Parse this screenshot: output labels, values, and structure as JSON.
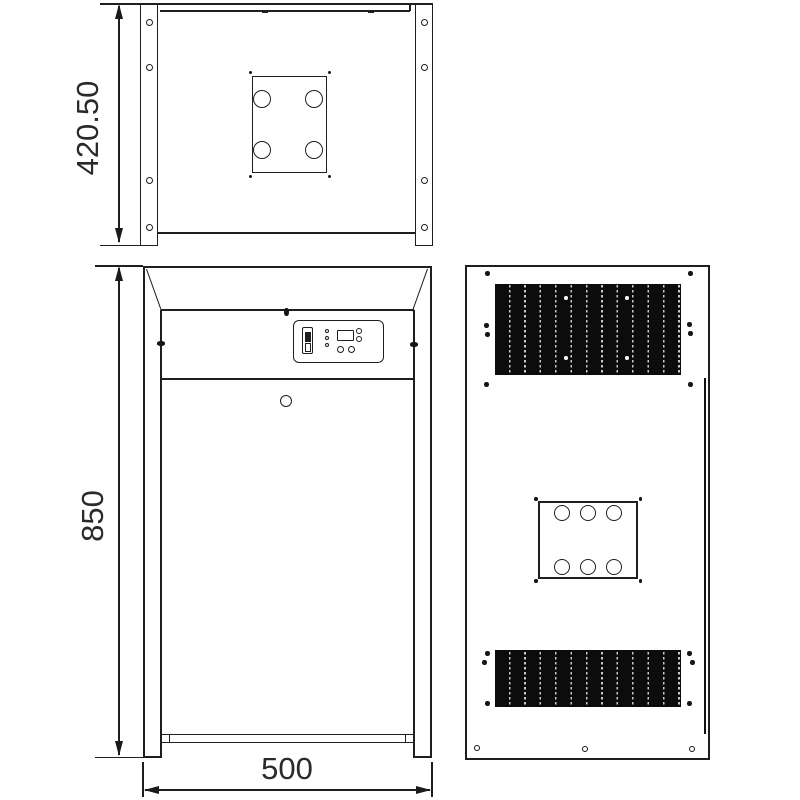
{
  "drawing": {
    "labels": {
      "depth": "420.50",
      "height": "850",
      "width": "500"
    },
    "colors": {
      "line": "#1f1f1f",
      "background": "#ffffff",
      "grille_fill": "#0c0c0c",
      "grille_slot": "#c9c9c9"
    }
  }
}
